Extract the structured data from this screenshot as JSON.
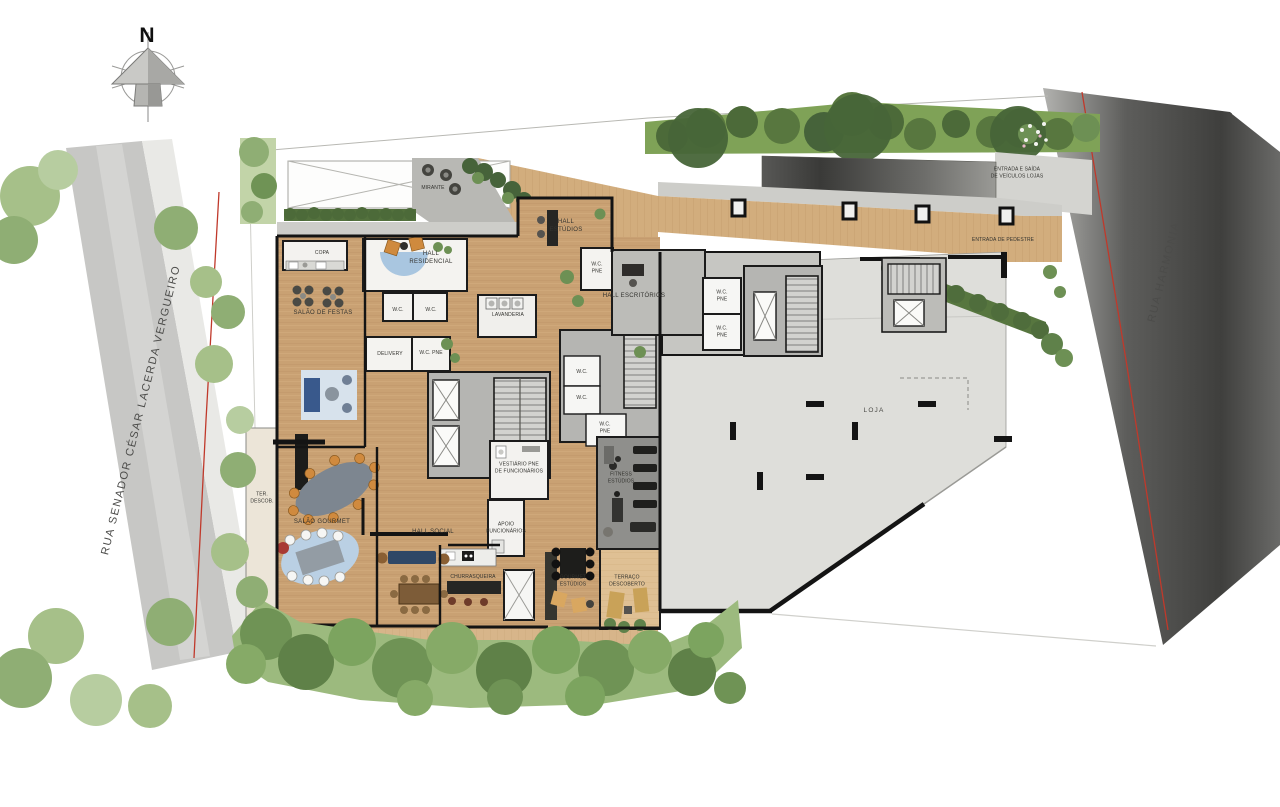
{
  "compass": {
    "label": "N"
  },
  "streets": {
    "left": "RUA SENADOR CÉSAR LACERDA VERGUEIRO",
    "right": "RUA HARMONIA"
  },
  "site": {
    "entrada_veiculos": "ENTRADA E SAÍDA\nDE VEÍCULOS LOJAS",
    "entrada_pedestre": "ENTRADA DE PEDESTRE",
    "mirante": "MIRANTE"
  },
  "rooms": {
    "copa": "COPA",
    "hall_residencial": "HALL\nRESIDENCIAL",
    "hall_estudios": "HALL\nESTÚDIOS",
    "salao_de_festas": "SALÃO DE FESTAS",
    "wc": "W.C.",
    "wc_pne": "W.C.\nPNE",
    "wc_pne_inline": "W.C. PNE",
    "lavanderia": "LAVANDERIA",
    "hall_escritorios": "HALL ESCRITÓRIOS",
    "delivery": "DELIVERY",
    "vestiario_pne": "VESTIÁRIO PNE\nDE FUNCIONÁRIOS",
    "fitness_estudios": "FITNESS\nESTÚDIOS",
    "apoio_funcionarios": "APOIO\nFUNCIONÁRIOS",
    "ter_descob": "TER.\nDESCOB.",
    "salao_gourmet": "SALÃO GOURMET",
    "hall_social": "HALL SOCIAL",
    "churrasqueira": "CHURRASQUEIRA",
    "gourmet_estudios": "GOURMET\nESTÚDIOS",
    "terraco_descoberto": "TERRAÇO\nDESCOBERTO",
    "loja": "LOJA"
  },
  "colors": {
    "wood_floor": "#c9a173",
    "deck_wood": "#d2ad7d",
    "terrace_wood": "#dfc094",
    "loja_slab": "#dededa",
    "core_gray": "#b5b5b2",
    "street_left": "#c7c7c5",
    "street_right": "#4c4c4a",
    "property_line_red": "#c0392b",
    "hedge_green": "#4c6a39",
    "tree_green": "#8fae74",
    "wall_black": "#141414"
  }
}
